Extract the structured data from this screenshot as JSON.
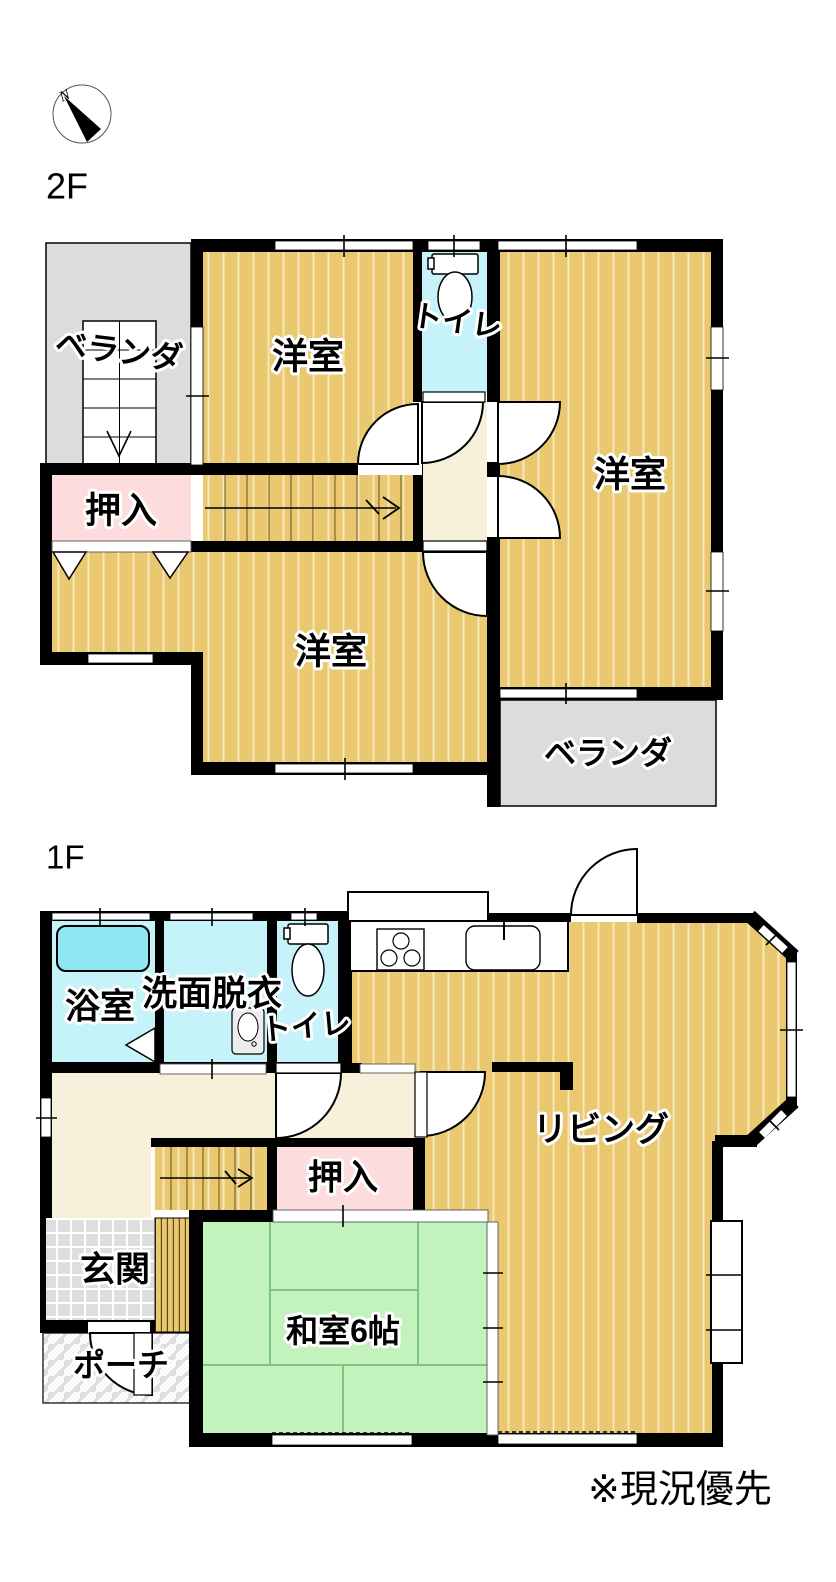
{
  "palette": {
    "wall": "#000000",
    "wood": "#e9c870",
    "wood_stripe": "#f6e6bb",
    "water": "#c6f3f9",
    "tub": "#8fe8f1",
    "closet_pink": "#fcdcdc",
    "tatami_green": "#c2f3bd",
    "tatami_line": "#7fc57f",
    "hallway_cream": "#f7f0da",
    "veranda_gray": "#dcdcdc",
    "tile_gray": "#dedede"
  },
  "compass": {
    "north_label": "N"
  },
  "floors": {
    "f2": {
      "label": "2F",
      "rooms": {
        "bedroom_nw": "洋室",
        "toilet": "トイレ",
        "bedroom_e": "洋室",
        "bedroom_s": "洋室",
        "closet": "押入",
        "veranda_nw": "ベランダ",
        "veranda_se": "ベランダ"
      }
    },
    "f1": {
      "label": "1F",
      "rooms": {
        "bath": "浴室",
        "washroom": "洗面脱衣",
        "toilet": "トイレ",
        "living": "リビング",
        "closet": "押入",
        "entrance": "玄関",
        "japanese_room": "和室6帖",
        "porch": "ポーチ"
      }
    }
  },
  "note": "※現況優先"
}
